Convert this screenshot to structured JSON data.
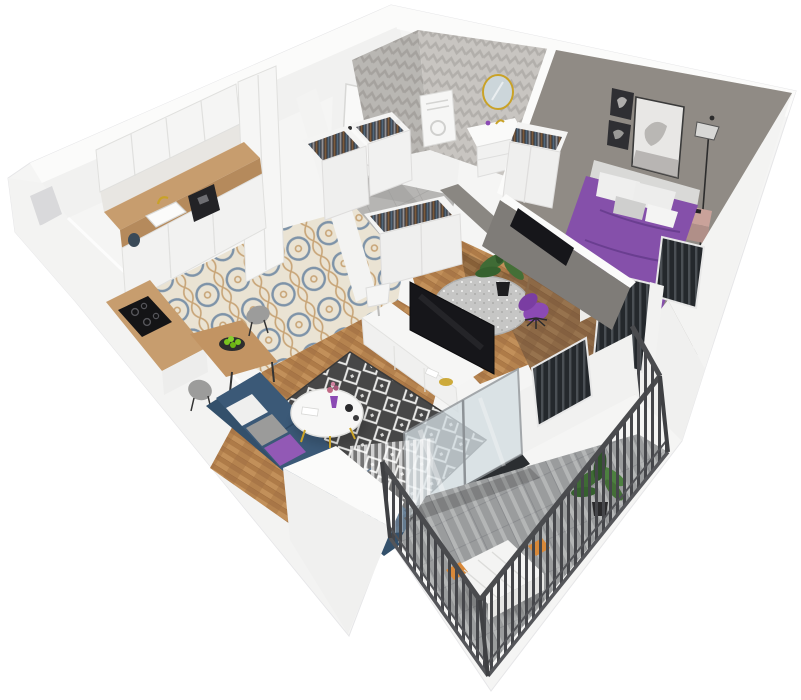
{
  "scene": {
    "type": "3d-apartment-floorplan-render",
    "background": "#ffffff",
    "rooms": [
      {
        "id": "kitchen-dining",
        "floor": "patterned-tile-and-wood",
        "furniture": [
          "upper-cabinets",
          "kitchen-counter",
          "sink",
          "coffee-machine",
          "kettle",
          "tall-cabinet",
          "cooktop-island",
          "dining-table",
          "fruit-plate",
          "dining-chairs"
        ]
      },
      {
        "id": "living-room",
        "floor": "herringbone-wood",
        "furniture": [
          "corner-sofa",
          "throw-pillows",
          "coffee-table",
          "area-rug",
          "tv-sideboard",
          "table-lamp",
          "tv",
          "sheer-curtains",
          "balcony-door"
        ]
      },
      {
        "id": "hallway",
        "floor": "grey-tile",
        "furniture": [
          "entry-door",
          "open-wardrobes"
        ]
      },
      {
        "id": "bathroom",
        "walls": "chevron-tile",
        "furniture": [
          "round-mirror",
          "vanity-sink",
          "utility-cabinet"
        ]
      },
      {
        "id": "office-nook",
        "floor": "herringbone-wood",
        "furniture": [
          "desk",
          "desk-chair",
          "round-rug",
          "potted-plant",
          "wall-tv",
          "open-wardrobe"
        ]
      },
      {
        "id": "bedroom",
        "walls": "grey",
        "furniture": [
          "double-bed",
          "pillows",
          "headboard",
          "nightstand",
          "floor-lamp",
          "wall-art",
          "open-wardrobe",
          "railed-windows"
        ]
      },
      {
        "id": "balcony",
        "floor": "grey-tile",
        "furniture": [
          "metal-railing",
          "bench",
          "potted-plant"
        ]
      }
    ]
  },
  "palette": {
    "wall_white": "#f5f5f4",
    "wall_bright": "#fbfbfa",
    "wall_inner": "#f1f1f0",
    "wall_shade": "#ededec",
    "wall_block": "#f0f0ef",
    "bedroom_wall": "#9d9791",
    "accent_wall": "#7f7c78",
    "accent_wall_light": "#8a8782",
    "chevron_base": "#c8c5c1",
    "hall_tile": "#b6b5b3",
    "wood": "#b5834f",
    "counter_wood": "#c79d6e",
    "counter_edge": "#b58a5c",
    "tile_base": "#eae3d3",
    "tile_blue": "#7e93a8",
    "tile_tan": "#c8a578",
    "rug_dark": "#474747",
    "rug_line": "#e8e8e6",
    "office_rug": "#c6c6c5",
    "sofa": "#3b5977",
    "sofa_dark": "#33506b",
    "bed_purple": "#8550aa",
    "bed_purple_dark": "#5c3482",
    "chair_purple": "#8b4ab4",
    "tv_dark": "#16161a",
    "gold": "#c9a227",
    "balcony_tile": "#9a9c9d",
    "railing": "#4a4b4e",
    "bench_white": "#f4f4f3",
    "bench_orange": "#d8893a",
    "plant": "#3f6b35",
    "plant_light": "#4d8040",
    "apple": "#7ac41e",
    "flower": "#c06a85",
    "pillow_white": "#efefee",
    "pillow_grey": "#9b9b9a",
    "headboard": "#d9d9d7",
    "nightstand": "#c9a29a",
    "glass": "#d3dde2",
    "threshold": "#2b2e31",
    "door_white": "#f9f9f8",
    "appliance_dark": "#232326",
    "clothes_rail": "#303036"
  }
}
